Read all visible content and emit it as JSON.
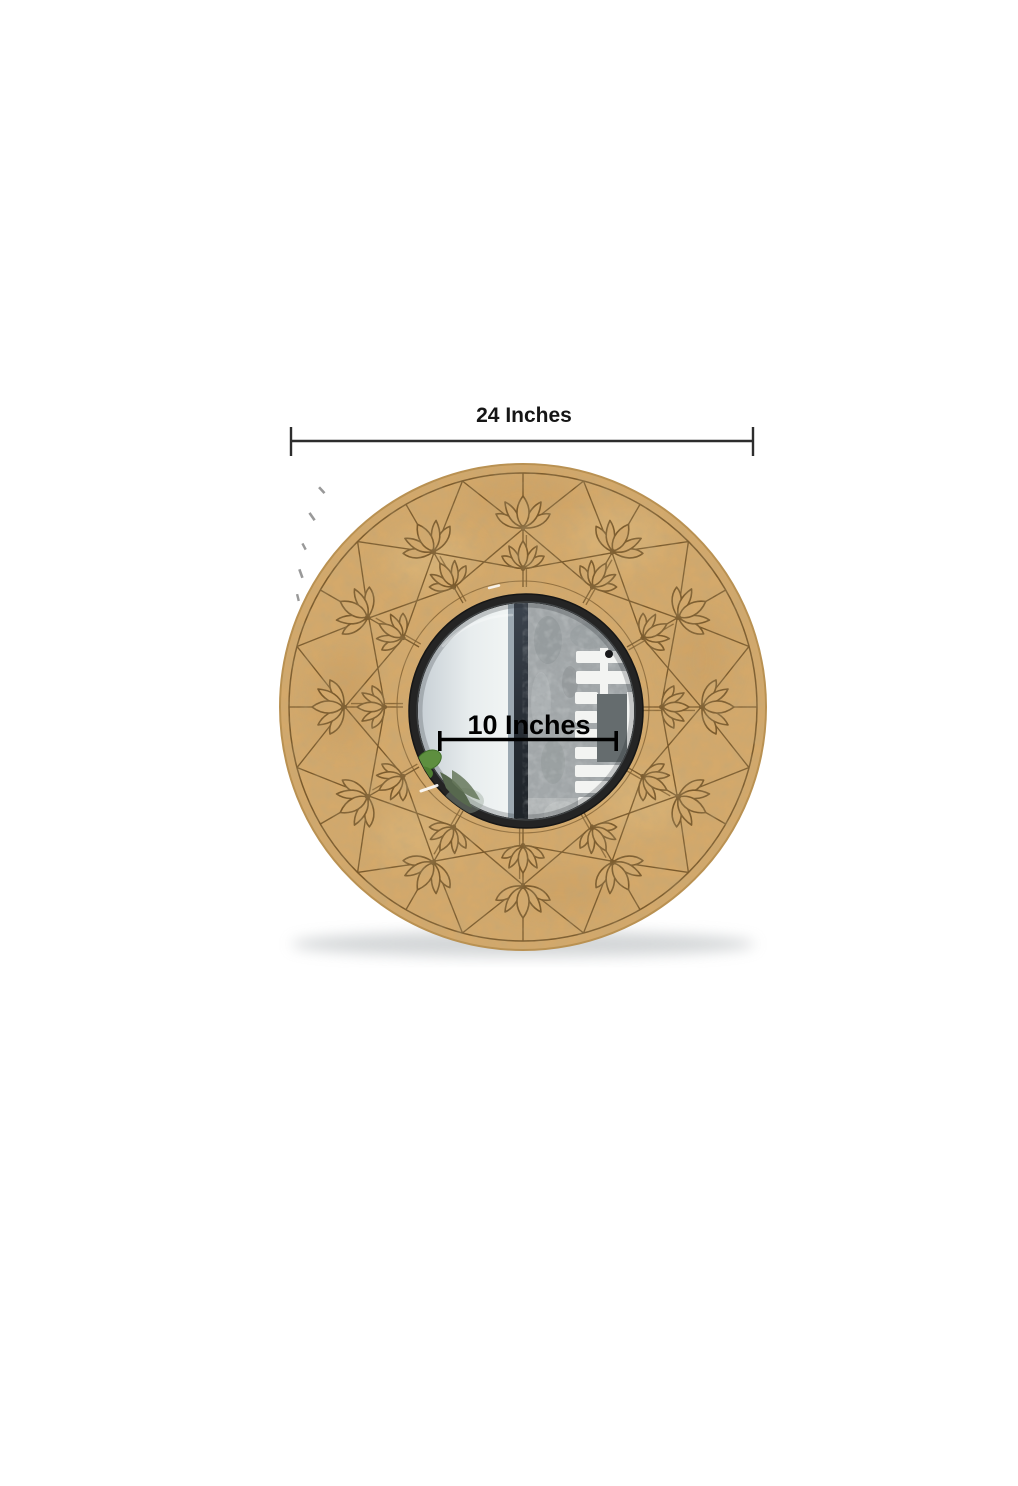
{
  "page": {
    "background": "#ffffff"
  },
  "figure": {
    "subject": "round-wooden-wall-mirror-with-lotus-engraving",
    "wood_color": "#d4a96b",
    "engraving_color": "#7a5a2c",
    "mirror_rim_color": "#242424"
  },
  "dimensions": {
    "outer": {
      "label": "24 Inches"
    },
    "inner": {
      "label": "10 Inches"
    }
  }
}
